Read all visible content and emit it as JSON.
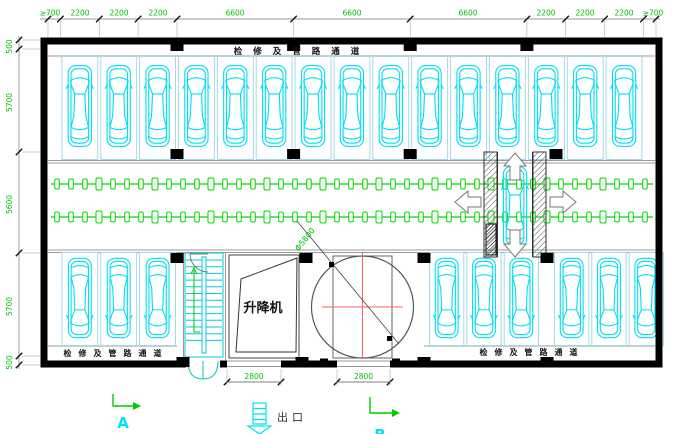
{
  "drawing": {
    "corridor_label_top": "检修及管路通道",
    "corridor_label_bottom_left": "检修及管路通道",
    "corridor_label_bottom_right": "检修及管路通道",
    "lift_room_label": "升降机",
    "exit_label": "出口",
    "section_mark_a": "A",
    "section_mark_b": "B",
    "turntable_diameter_label": "Φ5800"
  },
  "dimensions": {
    "top": [
      "≥700",
      "2200",
      "2200",
      "2200",
      "6600",
      "6600",
      "6600",
      "2200",
      "2200",
      "2200",
      "≥700"
    ],
    "left": [
      "500",
      "5700",
      "5600",
      "5700",
      "500"
    ],
    "bottom": [
      "2800",
      "2800"
    ]
  },
  "parking": {
    "top_row_car_count": 15,
    "bottom_left_car_count": 3,
    "bottom_right_car_count": 6,
    "lift_bay_car_count": 1
  },
  "colors": {
    "car_cyan": "#00dff2",
    "stall_border": "#a5d9ea",
    "stair_cyan": "#00ccdd",
    "dimension_green": "#00c300",
    "conveyor_green": "#00d800",
    "wall_black": "#000000",
    "crosshair_red": "#ff5f5f",
    "annotation_cyan": "#00e0f5",
    "door_cyan": "#00ccbb",
    "arrow_green": "#00cc00"
  }
}
